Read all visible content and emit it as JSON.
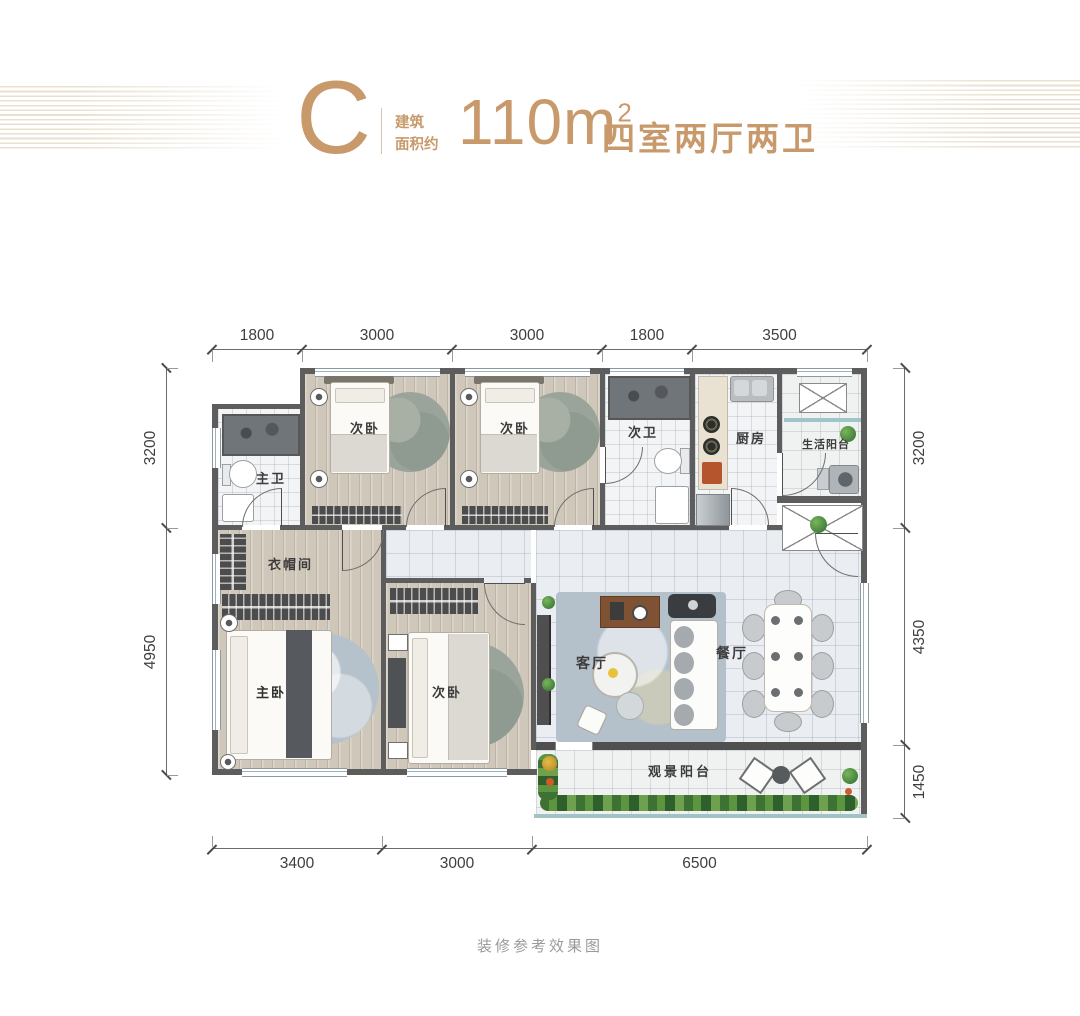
{
  "header": {
    "unit": "C",
    "area_label_line1": "建筑",
    "area_label_line2": "面积约",
    "area_value": "110m",
    "area_exponent": "2",
    "layout_text": "四室两厅两卫"
  },
  "rooms": {
    "master_bath": "主卫",
    "bedroom_top_left": "次卧",
    "bedroom_top_mid": "次卧",
    "second_bath": "次卫",
    "kitchen": "厨房",
    "service_balcony": "生活阳台",
    "cloakroom": "衣帽间",
    "master_bedroom": "主卧",
    "bedroom_bottom": "次卧",
    "living_room": "客厅",
    "dining_room": "餐厅",
    "view_balcony": "观景阳台"
  },
  "dimensions": {
    "top": [
      "1800",
      "3000",
      "3000",
      "1800",
      "3500"
    ],
    "bottom": [
      "3400",
      "3000",
      "6500"
    ],
    "left": [
      "3200",
      "4950"
    ],
    "right": [
      "3200",
      "4350",
      "1450"
    ]
  },
  "footer": {
    "caption": "装修参考效果图"
  },
  "colors": {
    "accent": "#c89a6b",
    "wall": "#5d5d5d",
    "wood_floor": "#cfc7b9",
    "tile_floor": "#eaedf1",
    "stripe": "#e9e0cf",
    "dimension_text": "#3e3e3e",
    "caption_text": "#9a9a9a"
  }
}
